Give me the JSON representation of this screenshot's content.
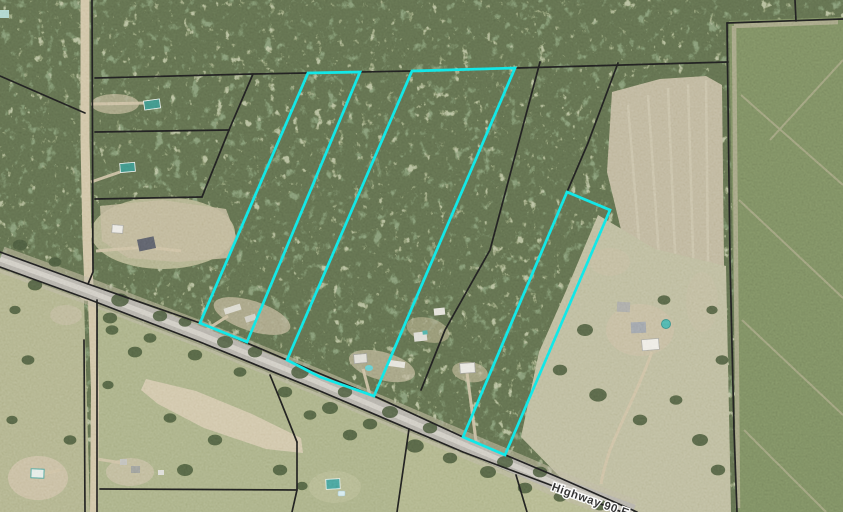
{
  "map": {
    "road_label": "Highway 90 E",
    "colors": {
      "parcel_highlight": "#00e4e4",
      "parcel_boundary": "#101010",
      "pavement": "#a8a49b",
      "road_center": "#c9c5bb",
      "dirt_road": "#c9ba96",
      "label_text": "#1f1f1f",
      "label_halo": "#ffffff"
    },
    "highlighted_parcels": [
      {
        "id": "highlighted-parcel-1",
        "points": "308,73 360,72 247,342 200,323"
      },
      {
        "id": "highlighted-parcel-2",
        "points": "412,71 515,68 374,396 320,377 287,360"
      },
      {
        "id": "highlighted-parcel-3",
        "points": "567,192 610,210 505,455 463,437"
      }
    ],
    "boundary_lines": [
      "95,78 253,74 412,71 728,62",
      "727,23 843,19",
      "795,0 796,21",
      "727,23 730,260 734,430 737,512",
      "92,0 93,272 88,284",
      "0,76 85,113",
      "253,74 229,130",
      "95,132 229,130",
      "229,130 202,197",
      "95,199 202,197",
      "540,62 490,250 445,330 421,390",
      "618,63 588,143 567,192",
      "0,252 88,284 200,323 287,360 374,396 463,437 560,478 637,512",
      "0,267 88,299 200,342 320,391 463,452 622,512",
      "409,429 397,512",
      "516,475 527,512",
      "100,489 297,490",
      "297,442 297,490 292,512",
      "297,442 281,402 270,375",
      "97,300 97,512",
      "84,340 85,512"
    ]
  }
}
